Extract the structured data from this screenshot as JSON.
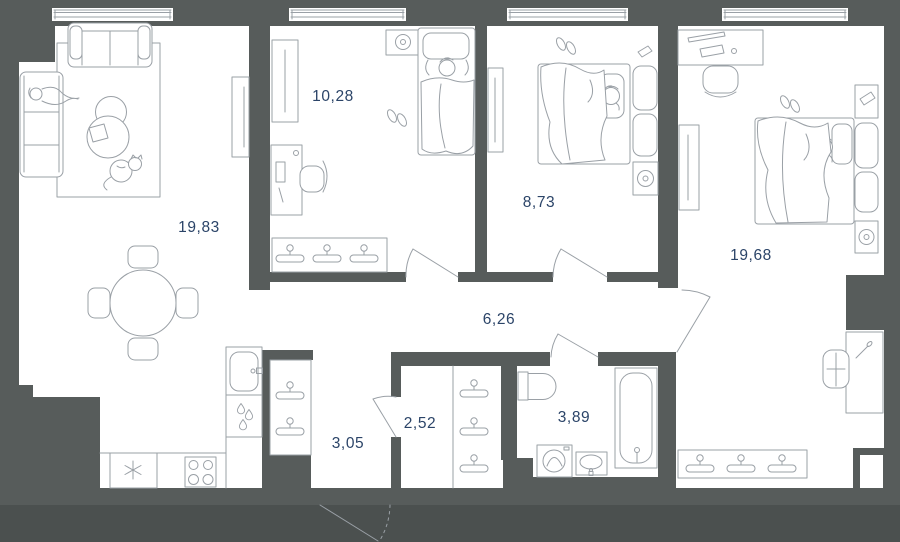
{
  "plan": {
    "type": "apartment-floor-plan",
    "area_unit_visible": false
  },
  "colors": {
    "wall": "#575c5b",
    "background_lower": "#4b504f",
    "floor": "#ffffff",
    "line": "#9aa0a6",
    "label": "#2b4468"
  },
  "rooms": [
    {
      "id": "living-room",
      "area_label": "19,83",
      "furniture": [
        "sofa",
        "chaise-sofa",
        "person",
        "rug",
        "coffee-tables",
        "magazine",
        "cat",
        "tv-panel",
        "dining-table",
        "dining-chairs",
        "kitchen-sink",
        "water-drops",
        "fridge",
        "stove"
      ]
    },
    {
      "id": "bedroom-small",
      "area_label": "10,28",
      "furniture": [
        "nightstand-speaker",
        "bed",
        "sleeping-child",
        "slippers",
        "mirror-cabinet",
        "desk",
        "desk-chair",
        "wardrobe-hangers"
      ]
    },
    {
      "id": "bedroom-middle",
      "area_label": "8,73",
      "furniture": [
        "bed",
        "sleeping-person",
        "slippers",
        "mirror-cabinet",
        "nightstands",
        "speaker",
        "slipper-shelf"
      ]
    },
    {
      "id": "bedroom-large",
      "area_label": "19,68",
      "furniture": [
        "desk",
        "desk-chair",
        "laptop",
        "mouse",
        "mirror-cabinet",
        "bed",
        "sleeping-person",
        "slippers",
        "nightstands",
        "speaker",
        "slipper-shelf",
        "side-desk",
        "armchair",
        "wardrobe-hangers"
      ]
    },
    {
      "id": "hallway",
      "area_label": "6,26",
      "furniture": []
    },
    {
      "id": "corridor-entry",
      "area_label": "3,05",
      "furniture": [
        "wardrobe-hangers"
      ]
    },
    {
      "id": "closet",
      "area_label": "2,52",
      "furniture": [
        "wardrobe-hangers"
      ]
    },
    {
      "id": "bathroom",
      "area_label": "3,89",
      "furniture": [
        "toilet",
        "washing-machine",
        "sink",
        "bathtub"
      ]
    }
  ],
  "openings": {
    "windows": 4,
    "interior_doors": 5,
    "entry_door": 1
  }
}
